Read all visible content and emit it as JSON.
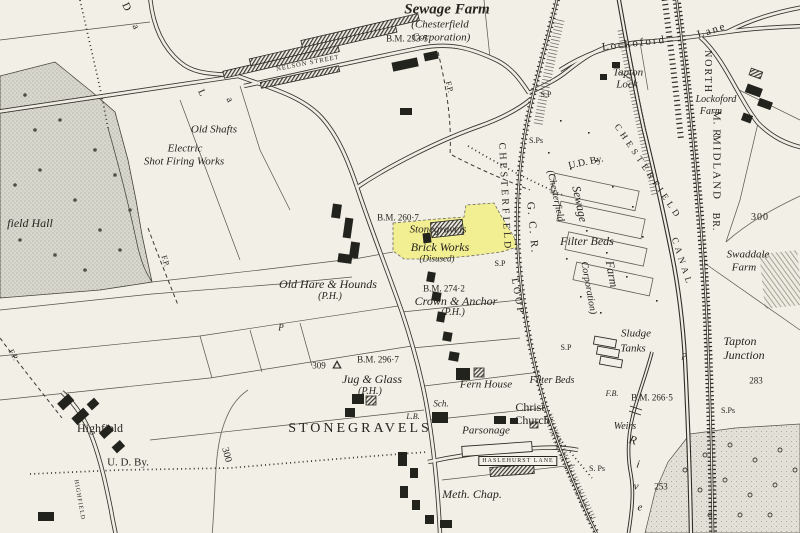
{
  "map": {
    "paper_color": "#f1efe6",
    "ink_color": "#2b2a24",
    "parkland_color": "#d9d8cf",
    "highlight": {
      "name": "Stonegravels Brick Works (Disused)",
      "color": "#f3ee84"
    },
    "labels": [
      {
        "t": "Sewage Farm",
        "x": 447,
        "y": 10,
        "s": 15,
        "cls": "bi"
      },
      {
        "t": "(Chesterfield",
        "x": 440,
        "y": 25,
        "s": 11,
        "cls": "i"
      },
      {
        "t": "Corporation)",
        "x": 441,
        "y": 38,
        "s": 11,
        "cls": "i"
      },
      {
        "t": "B.M. 233·5",
        "x": 407,
        "y": 39,
        "s": 9,
        "cls": "r"
      },
      {
        "t": "NELSON STREET",
        "x": 308,
        "y": 64,
        "s": 6.5,
        "r": -11,
        "ls": 1,
        "cls": "c"
      },
      {
        "t": "D",
        "x": 126,
        "y": 7,
        "s": 11,
        "r": 65,
        "cls": "r"
      },
      {
        "t": "a",
        "x": 135,
        "y": 27,
        "s": 10,
        "r": 65,
        "cls": "r"
      },
      {
        "t": "L",
        "x": 201,
        "y": 93,
        "s": 10,
        "r": 65,
        "cls": "r"
      },
      {
        "t": "a",
        "x": 229,
        "y": 100,
        "s": 10,
        "r": 65,
        "cls": "r"
      },
      {
        "t": "F.P.",
        "x": 449,
        "y": 87,
        "s": 8,
        "r": 75,
        "cls": "r"
      },
      {
        "t": "S.P",
        "x": 546,
        "y": 95,
        "s": 8,
        "cls": "r"
      },
      {
        "t": "Lockoford",
        "x": 634,
        "y": 44,
        "s": 11,
        "r": -7,
        "ls": 2,
        "cls": "r"
      },
      {
        "t": "Lane",
        "x": 712,
        "y": 31,
        "s": 11,
        "r": -18,
        "ls": 2,
        "cls": "r"
      },
      {
        "t": "NORTH",
        "x": 707,
        "y": 72,
        "s": 10,
        "r": 90,
        "ls": 2,
        "cls": "c"
      },
      {
        "t": "Tapton",
        "x": 628,
        "y": 73,
        "s": 11,
        "cls": "i"
      },
      {
        "t": "Lock",
        "x": 627,
        "y": 85,
        "s": 11,
        "cls": "i"
      },
      {
        "t": "Lockoford",
        "x": 716,
        "y": 100,
        "s": 10,
        "cls": "i"
      },
      {
        "t": "Farm",
        "x": 711,
        "y": 112,
        "s": 10,
        "cls": "i"
      },
      {
        "t": "M. R.",
        "x": 716,
        "y": 126,
        "s": 11,
        "r": 90,
        "ls": 1,
        "cls": "c"
      },
      {
        "t": "MIDLAND",
        "x": 716,
        "y": 168,
        "s": 11,
        "r": 90,
        "ls": 2,
        "cls": "c"
      },
      {
        "t": "BR.",
        "x": 715,
        "y": 222,
        "s": 10,
        "r": 90,
        "ls": 1,
        "cls": "c"
      },
      {
        "t": "300",
        "x": 760,
        "y": 218,
        "s": 10,
        "ls": 1,
        "cls": "r"
      },
      {
        "t": "Swaddale",
        "x": 748,
        "y": 255,
        "s": 11,
        "cls": "i"
      },
      {
        "t": "Farm",
        "x": 744,
        "y": 268,
        "s": 11,
        "cls": "i"
      },
      {
        "t": "Old Shafts",
        "x": 214,
        "y": 130,
        "s": 11,
        "cls": "i"
      },
      {
        "t": "Electric",
        "x": 185,
        "y": 149,
        "s": 11,
        "cls": "i"
      },
      {
        "t": "Shot Firing Works",
        "x": 184,
        "y": 162,
        "s": 11,
        "cls": "i"
      },
      {
        "t": "field Hall",
        "x": 30,
        "y": 223,
        "s": 12,
        "cls": "i"
      },
      {
        "t": "F.P.",
        "x": 165,
        "y": 261,
        "s": 8,
        "r": 72,
        "cls": "r"
      },
      {
        "t": "B.M. 260·7",
        "x": 398,
        "y": 218,
        "s": 9,
        "cls": "r"
      },
      {
        "t": "Stonegravels",
        "x": 438,
        "y": 230,
        "s": 11,
        "cls": "i"
      },
      {
        "t": "Brick Works",
        "x": 440,
        "y": 247,
        "s": 12,
        "cls": "i"
      },
      {
        "t": "(Disused)",
        "x": 437,
        "y": 259,
        "s": 9,
        "cls": "i"
      },
      {
        "t": "S.P",
        "x": 500,
        "y": 264,
        "s": 8,
        "cls": "r"
      },
      {
        "t": "CHESTERFIELD",
        "x": 504,
        "y": 197,
        "s": 10,
        "r": 87,
        "ls": 3,
        "cls": "c"
      },
      {
        "t": "LOOP",
        "x": 517,
        "y": 297,
        "s": 10,
        "r": 80,
        "ls": 3,
        "cls": "c"
      },
      {
        "t": "G. C. R.",
        "x": 532,
        "y": 228,
        "s": 11,
        "r": 85,
        "ls": 2,
        "cls": "c"
      },
      {
        "t": "S.Ps",
        "x": 536,
        "y": 141,
        "s": 8,
        "cls": "r"
      },
      {
        "t": "U.D. By.",
        "x": 586,
        "y": 163,
        "s": 10,
        "r": -12,
        "cls": "r"
      },
      {
        "t": "(Chesterfield",
        "x": 555,
        "y": 196,
        "s": 10,
        "r": 78,
        "cls": "i"
      },
      {
        "t": "Sewage",
        "x": 580,
        "y": 204,
        "s": 12,
        "r": 78,
        "cls": "i"
      },
      {
        "t": "Corporation)",
        "x": 588,
        "y": 288,
        "s": 10,
        "r": 80,
        "cls": "i"
      },
      {
        "t": "Filter Beds",
        "x": 587,
        "y": 241,
        "s": 12,
        "cls": "i"
      },
      {
        "t": "Farm",
        "x": 612,
        "y": 274,
        "s": 12,
        "r": 80,
        "cls": "i"
      },
      {
        "t": "CHESTERFIELD",
        "x": 648,
        "y": 172,
        "s": 9,
        "r": 56,
        "ls": 4,
        "cls": "c"
      },
      {
        "t": "CANAL",
        "x": 682,
        "y": 262,
        "s": 9,
        "r": 72,
        "ls": 4,
        "cls": "c"
      },
      {
        "t": "Old Hare & Hounds",
        "x": 328,
        "y": 284,
        "s": 12,
        "cls": "i"
      },
      {
        "t": "(P.H.)",
        "x": 330,
        "y": 297,
        "s": 10,
        "cls": "i"
      },
      {
        "t": "B.M. 274·2",
        "x": 444,
        "y": 289,
        "s": 9,
        "cls": "r"
      },
      {
        "t": "Crown & Anchor",
        "x": 456,
        "y": 301,
        "s": 12,
        "cls": "i"
      },
      {
        "t": "(P.H.)",
        "x": 453,
        "y": 313,
        "s": 10,
        "cls": "i"
      },
      {
        "t": "P",
        "x": 281,
        "y": 328,
        "s": 9,
        "cls": "i"
      },
      {
        "t": "Tapton",
        "x": 740,
        "y": 341,
        "s": 12,
        "cls": "i"
      },
      {
        "t": "Junction",
        "x": 744,
        "y": 355,
        "s": 12,
        "cls": "i"
      },
      {
        "t": "283",
        "x": 756,
        "y": 381,
        "s": 9,
        "cls": "r"
      },
      {
        "t": "S.Ps",
        "x": 728,
        "y": 411,
        "s": 8,
        "cls": "r"
      },
      {
        "t": "309",
        "x": 319,
        "y": 366,
        "s": 9,
        "cls": "r"
      },
      {
        "t": "△",
        "x": 337,
        "y": 365,
        "s": 9,
        "cls": "r"
      },
      {
        "t": "B.M. 296·7",
        "x": 378,
        "y": 360,
        "s": 9,
        "cls": "r"
      },
      {
        "t": "Jug & Glass",
        "x": 372,
        "y": 379,
        "s": 12,
        "cls": "i"
      },
      {
        "t": "(P.H.)",
        "x": 370,
        "y": 392,
        "s": 10,
        "cls": "i"
      },
      {
        "t": "Fern House",
        "x": 486,
        "y": 385,
        "s": 11,
        "cls": "i"
      },
      {
        "t": "Filter Beds",
        "x": 552,
        "y": 381,
        "s": 10,
        "cls": "i"
      },
      {
        "t": "Sch.",
        "x": 441,
        "y": 404,
        "s": 9,
        "cls": "i"
      },
      {
        "t": "L.B.",
        "x": 413,
        "y": 417,
        "s": 8,
        "cls": "i"
      },
      {
        "t": "Christ",
        "x": 530,
        "y": 407,
        "s": 12,
        "cls": "r"
      },
      {
        "t": "Church",
        "x": 532,
        "y": 420,
        "s": 12,
        "cls": "r"
      },
      {
        "t": "STONEGRAVELS",
        "x": 360,
        "y": 429,
        "s": 14,
        "ls": 3,
        "cls": "c"
      },
      {
        "t": "Parsonage",
        "x": 486,
        "y": 431,
        "s": 11,
        "cls": "i"
      },
      {
        "t": "HASLEHURST LANE",
        "x": 518,
        "y": 461,
        "s": 6,
        "ls": 1,
        "cls": "c",
        "box": true
      },
      {
        "t": "Meth. Chap.",
        "x": 472,
        "y": 494,
        "s": 12,
        "cls": "i"
      },
      {
        "t": "S. Ps",
        "x": 597,
        "y": 469,
        "s": 8,
        "cls": "r"
      },
      {
        "t": "Weirs",
        "x": 625,
        "y": 427,
        "s": 10,
        "cls": "i"
      },
      {
        "t": "F.B.",
        "x": 612,
        "y": 394,
        "s": 8,
        "cls": "i"
      },
      {
        "t": "B.M. 266·5",
        "x": 652,
        "y": 398,
        "s": 9,
        "cls": "r"
      },
      {
        "t": "Sludge",
        "x": 636,
        "y": 334,
        "s": 11,
        "cls": "i"
      },
      {
        "t": "Tanks",
        "x": 633,
        "y": 349,
        "s": 11,
        "cls": "i"
      },
      {
        "t": "P",
        "x": 684,
        "y": 357,
        "s": 9,
        "cls": "i"
      },
      {
        "t": "S.P",
        "x": 566,
        "y": 348,
        "s": 8,
        "cls": "r"
      },
      {
        "t": "253",
        "x": 661,
        "y": 487,
        "s": 9,
        "cls": "r"
      },
      {
        "t": "R",
        "x": 633,
        "y": 440,
        "s": 12,
        "r": 15,
        "cls": "i"
      },
      {
        "t": "i",
        "x": 638,
        "y": 465,
        "s": 11,
        "r": 10,
        "cls": "i"
      },
      {
        "t": "v",
        "x": 636,
        "y": 487,
        "s": 11,
        "r": 5,
        "cls": "i"
      },
      {
        "t": "e",
        "x": 640,
        "y": 508,
        "s": 11,
        "cls": "i"
      },
      {
        "t": "Highfield",
        "x": 100,
        "y": 428,
        "s": 12,
        "cls": "r"
      },
      {
        "t": "U. D. By.",
        "x": 128,
        "y": 463,
        "s": 11,
        "cls": "r"
      },
      {
        "t": "300",
        "x": 226,
        "y": 455,
        "s": 10,
        "r": 75,
        "cls": "r"
      },
      {
        "t": "HIGHFIELD",
        "x": 79,
        "y": 500,
        "s": 6,
        "r": 80,
        "ls": 1,
        "cls": "c"
      },
      {
        "t": "F.P.",
        "x": 13,
        "y": 355,
        "s": 8,
        "r": 60,
        "cls": "r"
      }
    ]
  }
}
